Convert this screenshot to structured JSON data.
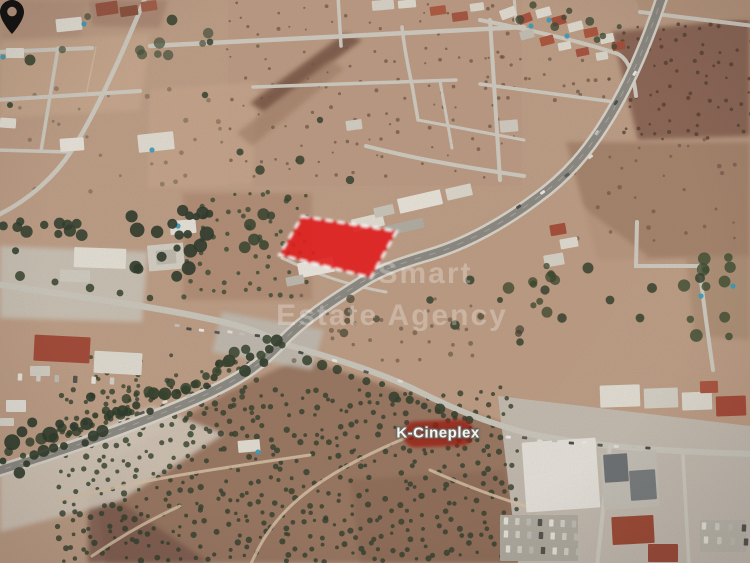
{
  "map": {
    "view": "satellite-aerial",
    "poi_label": "K-Cineplex",
    "watermark": {
      "line1": "Smart",
      "line2": "Estate Agency"
    },
    "marker": {
      "name": "location-pin",
      "color": "#161413",
      "tip_x": 327,
      "tip_y": 259,
      "width": 21,
      "height": 32
    },
    "parcel": {
      "points": "302,216 397,231 371,278 279,255",
      "fill": "#e01f1f",
      "fill_opacity": 0.9,
      "border_color": "#ffffff",
      "border_style": "dashed"
    }
  },
  "colors": {
    "terrain": "#c2a189",
    "dark_field": "#8a6452",
    "olive_grove": "#997661",
    "road_minor": "#d4d0c6",
    "road_highway": "#8e8c85",
    "building_white": "#ebe8e1",
    "roof_red": "#a84e3a",
    "pool_blue": "#3f9fbe",
    "label_background": "#981e12",
    "parcel_red": "#e01f1f"
  }
}
